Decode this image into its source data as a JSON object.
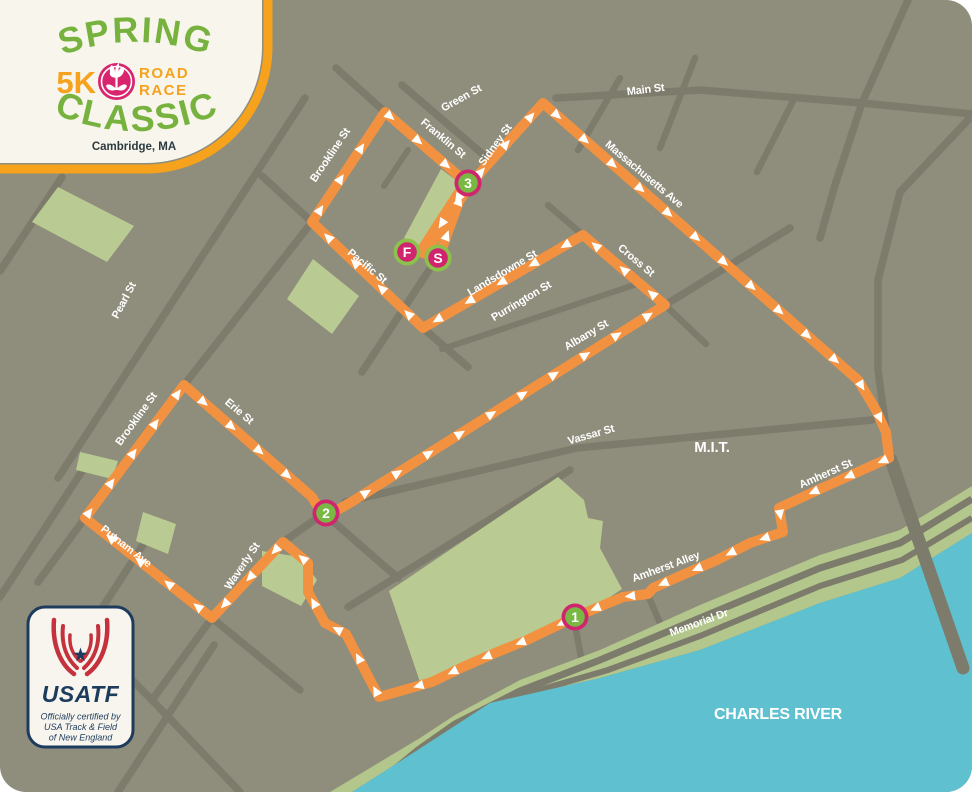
{
  "logo": {
    "title_top": "SPRING",
    "distance": "5K",
    "road": "ROAD",
    "race": "RACE",
    "title_bottom": "CLASSIC",
    "location": "Cambridge, MA",
    "colors": {
      "green": "#77b23f",
      "orange": "#f6a21c",
      "magenta": "#d8256e",
      "card": "#f7f5ec",
      "text_dark": "#2c3a40"
    }
  },
  "certification": {
    "brand": "USATF",
    "tagline_lines": [
      "Officially certified by",
      "USA Track & Field",
      "of New England"
    ],
    "colors": {
      "navy": "#1d3b5c",
      "red": "#c5313c",
      "card": "#f7f5ee"
    }
  },
  "map": {
    "colors": {
      "bg": "#8f8d7c",
      "street": "#7d7b6b",
      "park": "#b9cb92",
      "shore": "#b3c68c",
      "water": "#5fc1cf",
      "route": "#f29240",
      "arrow": "#ffffff",
      "magenta": "#d0246f",
      "green": "#79b843",
      "ring_green": "#8cc24c",
      "label": "#ffffff"
    },
    "street_labels": [
      {
        "text": "Green St",
        "x": 463,
        "y": 101,
        "r": -29,
        "s": 11
      },
      {
        "text": "Main St",
        "x": 646,
        "y": 93,
        "r": -7,
        "s": 11
      },
      {
        "text": "Franklin St",
        "x": 441,
        "y": 141,
        "r": 40,
        "s": 11
      },
      {
        "text": "Sidney St",
        "x": 498,
        "y": 147,
        "r": -54,
        "s": 11
      },
      {
        "text": "Brookline St",
        "x": 333,
        "y": 157,
        "r": -56,
        "s": 11
      },
      {
        "text": "Massachusetts Ave",
        "x": 642,
        "y": 177,
        "r": 40,
        "s": 11
      },
      {
        "text": "Pacific St",
        "x": 365,
        "y": 269,
        "r": 40,
        "s": 11
      },
      {
        "text": "Landsdowne St",
        "x": 504,
        "y": 276,
        "r": -31,
        "s": 11
      },
      {
        "text": "Purrington St",
        "x": 523,
        "y": 304,
        "r": -31,
        "s": 11
      },
      {
        "text": "Cross St",
        "x": 634,
        "y": 263,
        "r": 40,
        "s": 11
      },
      {
        "text": "Albany St",
        "x": 588,
        "y": 338,
        "r": -31,
        "s": 11
      },
      {
        "text": "Pearl St",
        "x": 127,
        "y": 302,
        "r": -62,
        "s": 11
      },
      {
        "text": "Brookline St",
        "x": 139,
        "y": 421,
        "r": -54,
        "s": 11
      },
      {
        "text": "Erie St",
        "x": 237,
        "y": 414,
        "r": 40,
        "s": 11
      },
      {
        "text": "Putnam Ave",
        "x": 124,
        "y": 549,
        "r": 38,
        "s": 11
      },
      {
        "text": "Waverly St",
        "x": 245,
        "y": 568,
        "r": -56,
        "s": 11
      },
      {
        "text": "Vassar St",
        "x": 592,
        "y": 438,
        "r": -16,
        "s": 11
      },
      {
        "text": "Amherst St",
        "x": 827,
        "y": 477,
        "r": -24,
        "s": 11
      },
      {
        "text": "Amherst Alley",
        "x": 667,
        "y": 570,
        "r": -20,
        "s": 11
      },
      {
        "text": "Memorial Dr",
        "x": 700,
        "y": 626,
        "r": -20,
        "s": 11
      },
      {
        "text": "M.I.T.",
        "x": 712,
        "y": 452,
        "r": 0,
        "s": 15,
        "w": 800
      },
      {
        "text": "CHARLES RIVER",
        "x": 778,
        "y": 719,
        "r": 0,
        "s": 16,
        "w": 800
      }
    ],
    "markers": [
      {
        "label": "F",
        "kind": "finish",
        "x": 407,
        "y": 252
      },
      {
        "label": "S",
        "kind": "start",
        "x": 438,
        "y": 258
      },
      {
        "label": "1",
        "kind": "mile",
        "x": 575,
        "y": 617
      },
      {
        "label": "2",
        "kind": "mile",
        "x": 326,
        "y": 513
      },
      {
        "label": "3",
        "kind": "mile",
        "x": 468,
        "y": 183
      }
    ],
    "route": {
      "main": [
        [
          439,
          257
        ],
        [
          462,
          193
        ],
        [
          543,
          103
        ],
        [
          858,
          380
        ],
        [
          876,
          410
        ],
        [
          886,
          432
        ],
        [
          889,
          458
        ],
        [
          820,
          489
        ],
        [
          779,
          508
        ],
        [
          783,
          532
        ],
        [
          750,
          543
        ],
        [
          717,
          560
        ],
        [
          687,
          573
        ],
        [
          653,
          588
        ],
        [
          648,
          594
        ],
        [
          623,
          597
        ],
        [
          575,
          617
        ],
        [
          527,
          640
        ],
        [
          495,
          653
        ],
        [
          463,
          667
        ],
        [
          432,
          682
        ],
        [
          379,
          697
        ],
        [
          346,
          634
        ],
        [
          325,
          623
        ],
        [
          308,
          592
        ],
        [
          308,
          563
        ],
        [
          283,
          542
        ],
        [
          212,
          618
        ],
        [
          85,
          518
        ],
        [
          184,
          385
        ],
        [
          312,
          497
        ],
        [
          319,
          509
        ],
        [
          328,
          514
        ],
        [
          341,
          508
        ],
        [
          353,
          501
        ],
        [
          665,
          305
        ],
        [
          583,
          235
        ],
        [
          423,
          328
        ],
        [
          312,
          222
        ],
        [
          385,
          112
        ],
        [
          468,
          184
        ]
      ],
      "finish_leg": [
        [
          466,
          186
        ],
        [
          424,
          251
        ]
      ]
    },
    "streets": [
      {
        "p": [
          [
            0,
            271
          ],
          [
            62,
            177
          ]
        ]
      },
      {
        "p": [
          [
            58,
            478
          ],
          [
            305,
            98
          ]
        ]
      },
      {
        "p": [
          [
            0,
            597
          ],
          [
            90,
            459
          ]
        ]
      },
      {
        "p": [
          [
            34,
            713
          ],
          [
            152,
            531
          ]
        ]
      },
      {
        "p": [
          [
            118,
            792
          ],
          [
            214,
            645
          ]
        ]
      },
      {
        "p": [
          [
            62,
            610
          ],
          [
            152,
            700
          ],
          [
            240,
            792
          ]
        ]
      },
      {
        "p": [
          [
            38,
            582
          ],
          [
            85,
            518
          ]
        ]
      },
      {
        "p": [
          [
            184,
            385
          ],
          [
            312,
            222
          ]
        ]
      },
      {
        "p": [
          [
            312,
            222
          ],
          [
            262,
            176
          ]
        ]
      },
      {
        "p": [
          [
            437,
            258
          ],
          [
            362,
            372
          ]
        ]
      },
      {
        "p": [
          [
            423,
            328
          ],
          [
            468,
            367
          ]
        ]
      },
      {
        "p": [
          [
            283,
            542
          ],
          [
            326,
            512
          ]
        ]
      },
      {
        "p": [
          [
            212,
            618
          ],
          [
            152,
            700
          ]
        ]
      },
      {
        "p": [
          [
            212,
            618
          ],
          [
            300,
            690
          ]
        ]
      },
      {
        "p": [
          [
            327,
            516
          ],
          [
            398,
            578
          ]
        ]
      },
      {
        "p": [
          [
            402,
            85
          ],
          [
            486,
            157
          ]
        ]
      },
      {
        "p": [
          [
            336,
            68
          ],
          [
            385,
            112
          ]
        ]
      },
      {
        "p": [
          [
            408,
            150
          ],
          [
            384,
            186
          ]
        ],
        "w": 6
      },
      {
        "p": [
          [
            556,
            98
          ],
          [
            700,
            90
          ],
          [
            862,
            103
          ],
          [
            972,
            114
          ]
        ]
      },
      {
        "p": [
          [
            908,
            0
          ],
          [
            862,
            103
          ]
        ]
      },
      {
        "p": [
          [
            620,
            78
          ],
          [
            578,
            150
          ]
        ],
        "w": 6.5
      },
      {
        "p": [
          [
            695,
            58
          ],
          [
            660,
            148
          ]
        ],
        "w": 6.5
      },
      {
        "p": [
          [
            793,
            101
          ],
          [
            757,
            172
          ]
        ],
        "w": 6.5
      },
      {
        "p": [
          [
            862,
            103
          ],
          [
            835,
            185
          ],
          [
            820,
            238
          ]
        ]
      },
      {
        "p": [
          [
            968,
            120
          ],
          [
            900,
            192
          ],
          [
            878,
            280
          ],
          [
            878,
            370
          ],
          [
            889,
            450
          ]
        ]
      },
      {
        "p": [
          [
            583,
            235
          ],
          [
            548,
            205
          ]
        ],
        "w": 6.5
      },
      {
        "p": [
          [
            665,
            305
          ],
          [
            706,
            344
          ]
        ],
        "w": 6.5
      },
      {
        "p": [
          [
            665,
            305
          ],
          [
            790,
            228
          ]
        ]
      },
      {
        "p": [
          [
            442,
            349
          ],
          [
            640,
            283
          ]
        ],
        "w": 6
      },
      {
        "p": [
          [
            345,
            502
          ],
          [
            577,
            448
          ],
          [
            872,
            420
          ]
        ]
      },
      {
        "p": [
          [
            574,
            620
          ],
          [
            585,
            678
          ]
        ],
        "w": 6.5
      },
      {
        "p": [
          [
            647,
            593
          ],
          [
            676,
            660
          ]
        ],
        "w": 6.5
      },
      {
        "p": [
          [
            348,
            607
          ],
          [
            570,
            470
          ]
        ]
      }
    ],
    "parks": [
      [
        [
          58,
          187
        ],
        [
          134,
          226
        ],
        [
          107,
          262
        ],
        [
          32,
          222
        ]
      ],
      [
        [
          313,
          259
        ],
        [
          359,
          296
        ],
        [
          332,
          334
        ],
        [
          287,
          299
        ]
      ],
      [
        [
          441,
          169
        ],
        [
          461,
          184
        ],
        [
          425,
          253
        ],
        [
          404,
          238
        ]
      ],
      [
        [
          80,
          452
        ],
        [
          118,
          461
        ],
        [
          112,
          479
        ],
        [
          76,
          470
        ]
      ],
      [
        [
          143,
          512
        ],
        [
          176,
          524
        ],
        [
          168,
          554
        ],
        [
          136,
          541
        ]
      ],
      [
        [
          262,
          551
        ],
        [
          300,
          557
        ],
        [
          317,
          580
        ],
        [
          301,
          606
        ],
        [
          262,
          586
        ]
      ],
      [
        [
          558,
          477
        ],
        [
          584,
          500
        ],
        [
          588,
          518
        ],
        [
          603,
          521
        ],
        [
          600,
          548
        ],
        [
          622,
          589
        ],
        [
          589,
          611
        ],
        [
          420,
          682
        ],
        [
          389,
          591
        ]
      ]
    ],
    "shore": {
      "band": [
        [
          972,
          486
        ],
        [
          900,
          530
        ],
        [
          820,
          555
        ],
        [
          700,
          605
        ],
        [
          600,
          650
        ],
        [
          520,
          680
        ],
        [
          455,
          715
        ],
        [
          420,
          738
        ],
        [
          330,
          792
        ],
        [
          352,
          792
        ],
        [
          413,
          753
        ],
        [
          490,
          703
        ],
        [
          600,
          678
        ],
        [
          700,
          650
        ],
        [
          820,
          603
        ],
        [
          900,
          578
        ],
        [
          972,
          533
        ]
      ],
      "roads": [
        [
          [
            972,
            499
          ],
          [
            900,
            543
          ],
          [
            820,
            568
          ],
          [
            700,
            618
          ],
          [
            600,
            660
          ],
          [
            520,
            691
          ],
          [
            455,
            724
          ],
          [
            418,
            750
          ],
          [
            372,
            788
          ]
        ],
        [
          [
            972,
            518
          ],
          [
            902,
            560
          ],
          [
            820,
            586
          ],
          [
            700,
            636
          ],
          [
            608,
            670
          ],
          [
            505,
            700
          ],
          [
            430,
            748
          ],
          [
            395,
            783
          ]
        ]
      ],
      "water": [
        [
          972,
          533
        ],
        [
          900,
          578
        ],
        [
          820,
          603
        ],
        [
          700,
          650
        ],
        [
          600,
          678
        ],
        [
          490,
          703
        ],
        [
          413,
          753
        ],
        [
          352,
          792
        ],
        [
          972,
          792
        ]
      ]
    },
    "bridge": [
      [
        891,
        460
      ],
      [
        963,
        668
      ]
    ]
  }
}
